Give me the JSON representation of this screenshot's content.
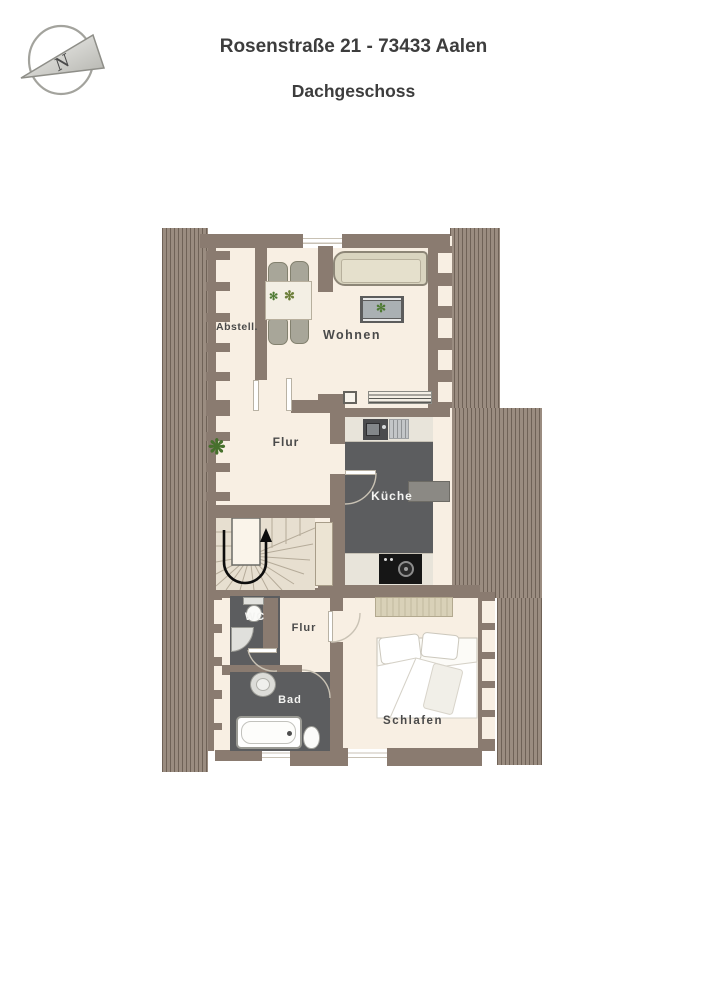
{
  "header": {
    "title": "Rosenstraße 21 - 73433 Aalen",
    "subtitle": "Dachgeschoss"
  },
  "compass": {
    "label": "N"
  },
  "rooms": {
    "abstell": {
      "label": "Abstell."
    },
    "wohnen": {
      "label": "Wohnen"
    },
    "flur_upper": {
      "label": "Flur"
    },
    "kueche": {
      "label": "Küche"
    },
    "wc": {
      "label": "WC"
    },
    "flur_lower": {
      "label": "Flur"
    },
    "bad": {
      "label": "Bad"
    },
    "schlafen": {
      "label": "Schlafen"
    }
  },
  "colors": {
    "wall": "#8a7b70",
    "roof_hatch": "#9a8c80",
    "floor": "#f8efe3",
    "dark_floor": "#5c5d5f",
    "label_text": "#4a4a4a",
    "label_text_light": "#f4f4f2",
    "title_text": "#3d3d3d"
  }
}
